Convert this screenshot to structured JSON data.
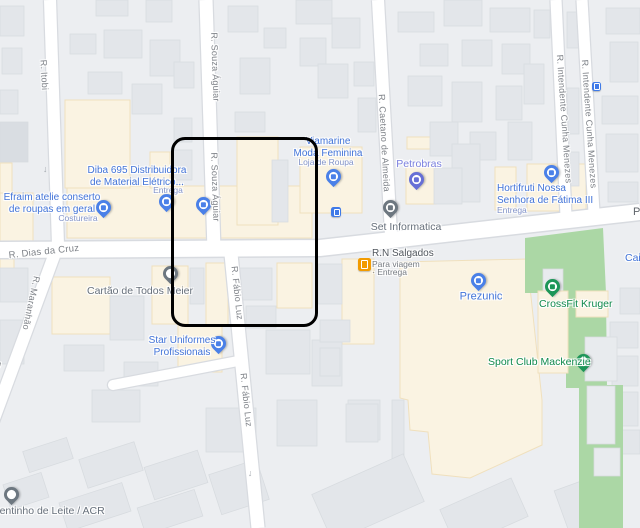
{
  "colors": {
    "background": "#eceef1",
    "building": "#e3e6ea",
    "building_stroke": "#d7dbdf",
    "road": "#ffffff",
    "road_casing": "#d8dbe0",
    "commercial_area": "#faf3e2",
    "commercial_area_stroke": "#f0e0bd",
    "park_green": "#abd7a5",
    "poi_blue": "#4173d8",
    "poi_sub_blue": "#8394ca",
    "poi_purple": "#7b80df",
    "poi_green": "#108a4d",
    "poi_grey": "#67707b",
    "poi_dark": "#51575e",
    "street_label": "#7d8187",
    "pin_blue": "#4a80e8",
    "pin_purple": "#666fd6",
    "pin_grey": "#6d7780",
    "pin_green": "#1d9658",
    "poi_orange": "#f29b00",
    "selection_outline": "#000000"
  },
  "streets": {
    "itobi": "R. Itobi",
    "souza_aguiar": "R. Souza Águiar",
    "fabio_luz": "R. Fábio Luz",
    "maranhao": "R. Maranhão",
    "dias_da_cruz": "R. Dias da Cruz",
    "caetano_de_almeida": "R. Caetano de Almeida",
    "intendente_cunha_menezes": "R. Intendente Cunha Menezes",
    "partial_label_right_edge": "P"
  },
  "pois": {
    "diba": {
      "line1": "Diba 695 Distribuidora",
      "line2": "de Material Elétrico...",
      "sub": "Entrega"
    },
    "efraim": {
      "line1": "Efraim atelie conserto",
      "line2": "de roupas em geral",
      "sub": "Costureira"
    },
    "viamarine": {
      "line1": "Viamarine",
      "line2": "Moda Feminina",
      "sub": "Loja de Roupa"
    },
    "petrobras": {
      "name": "Petrobras"
    },
    "hortifruti": {
      "line1": "Hortifruti Nossa",
      "line2": "Senhora de Fátima III",
      "sub": "Entrega"
    },
    "set_informatica": {
      "name": "Set Informatica"
    },
    "rn_salgados": {
      "name": "R.N Salgados",
      "sub1": "Para viagem",
      "sub2": "· Entrega"
    },
    "cartao_de_todos": {
      "name": "Cartão de Todos Meier"
    },
    "star_uniformes": {
      "line1": "Star Uniformes",
      "line2": "Profissionais"
    },
    "prezunic": {
      "name": "Prezunic"
    },
    "crossfit_kruger": {
      "name": "CrossFit Kruger"
    },
    "sport_club_mackenzie": {
      "name": "Sport Club Mackenzie"
    },
    "dentinho": {
      "name": "Dentinho de Leite / ACR"
    },
    "caixa": {
      "name": "Caixa"
    }
  }
}
